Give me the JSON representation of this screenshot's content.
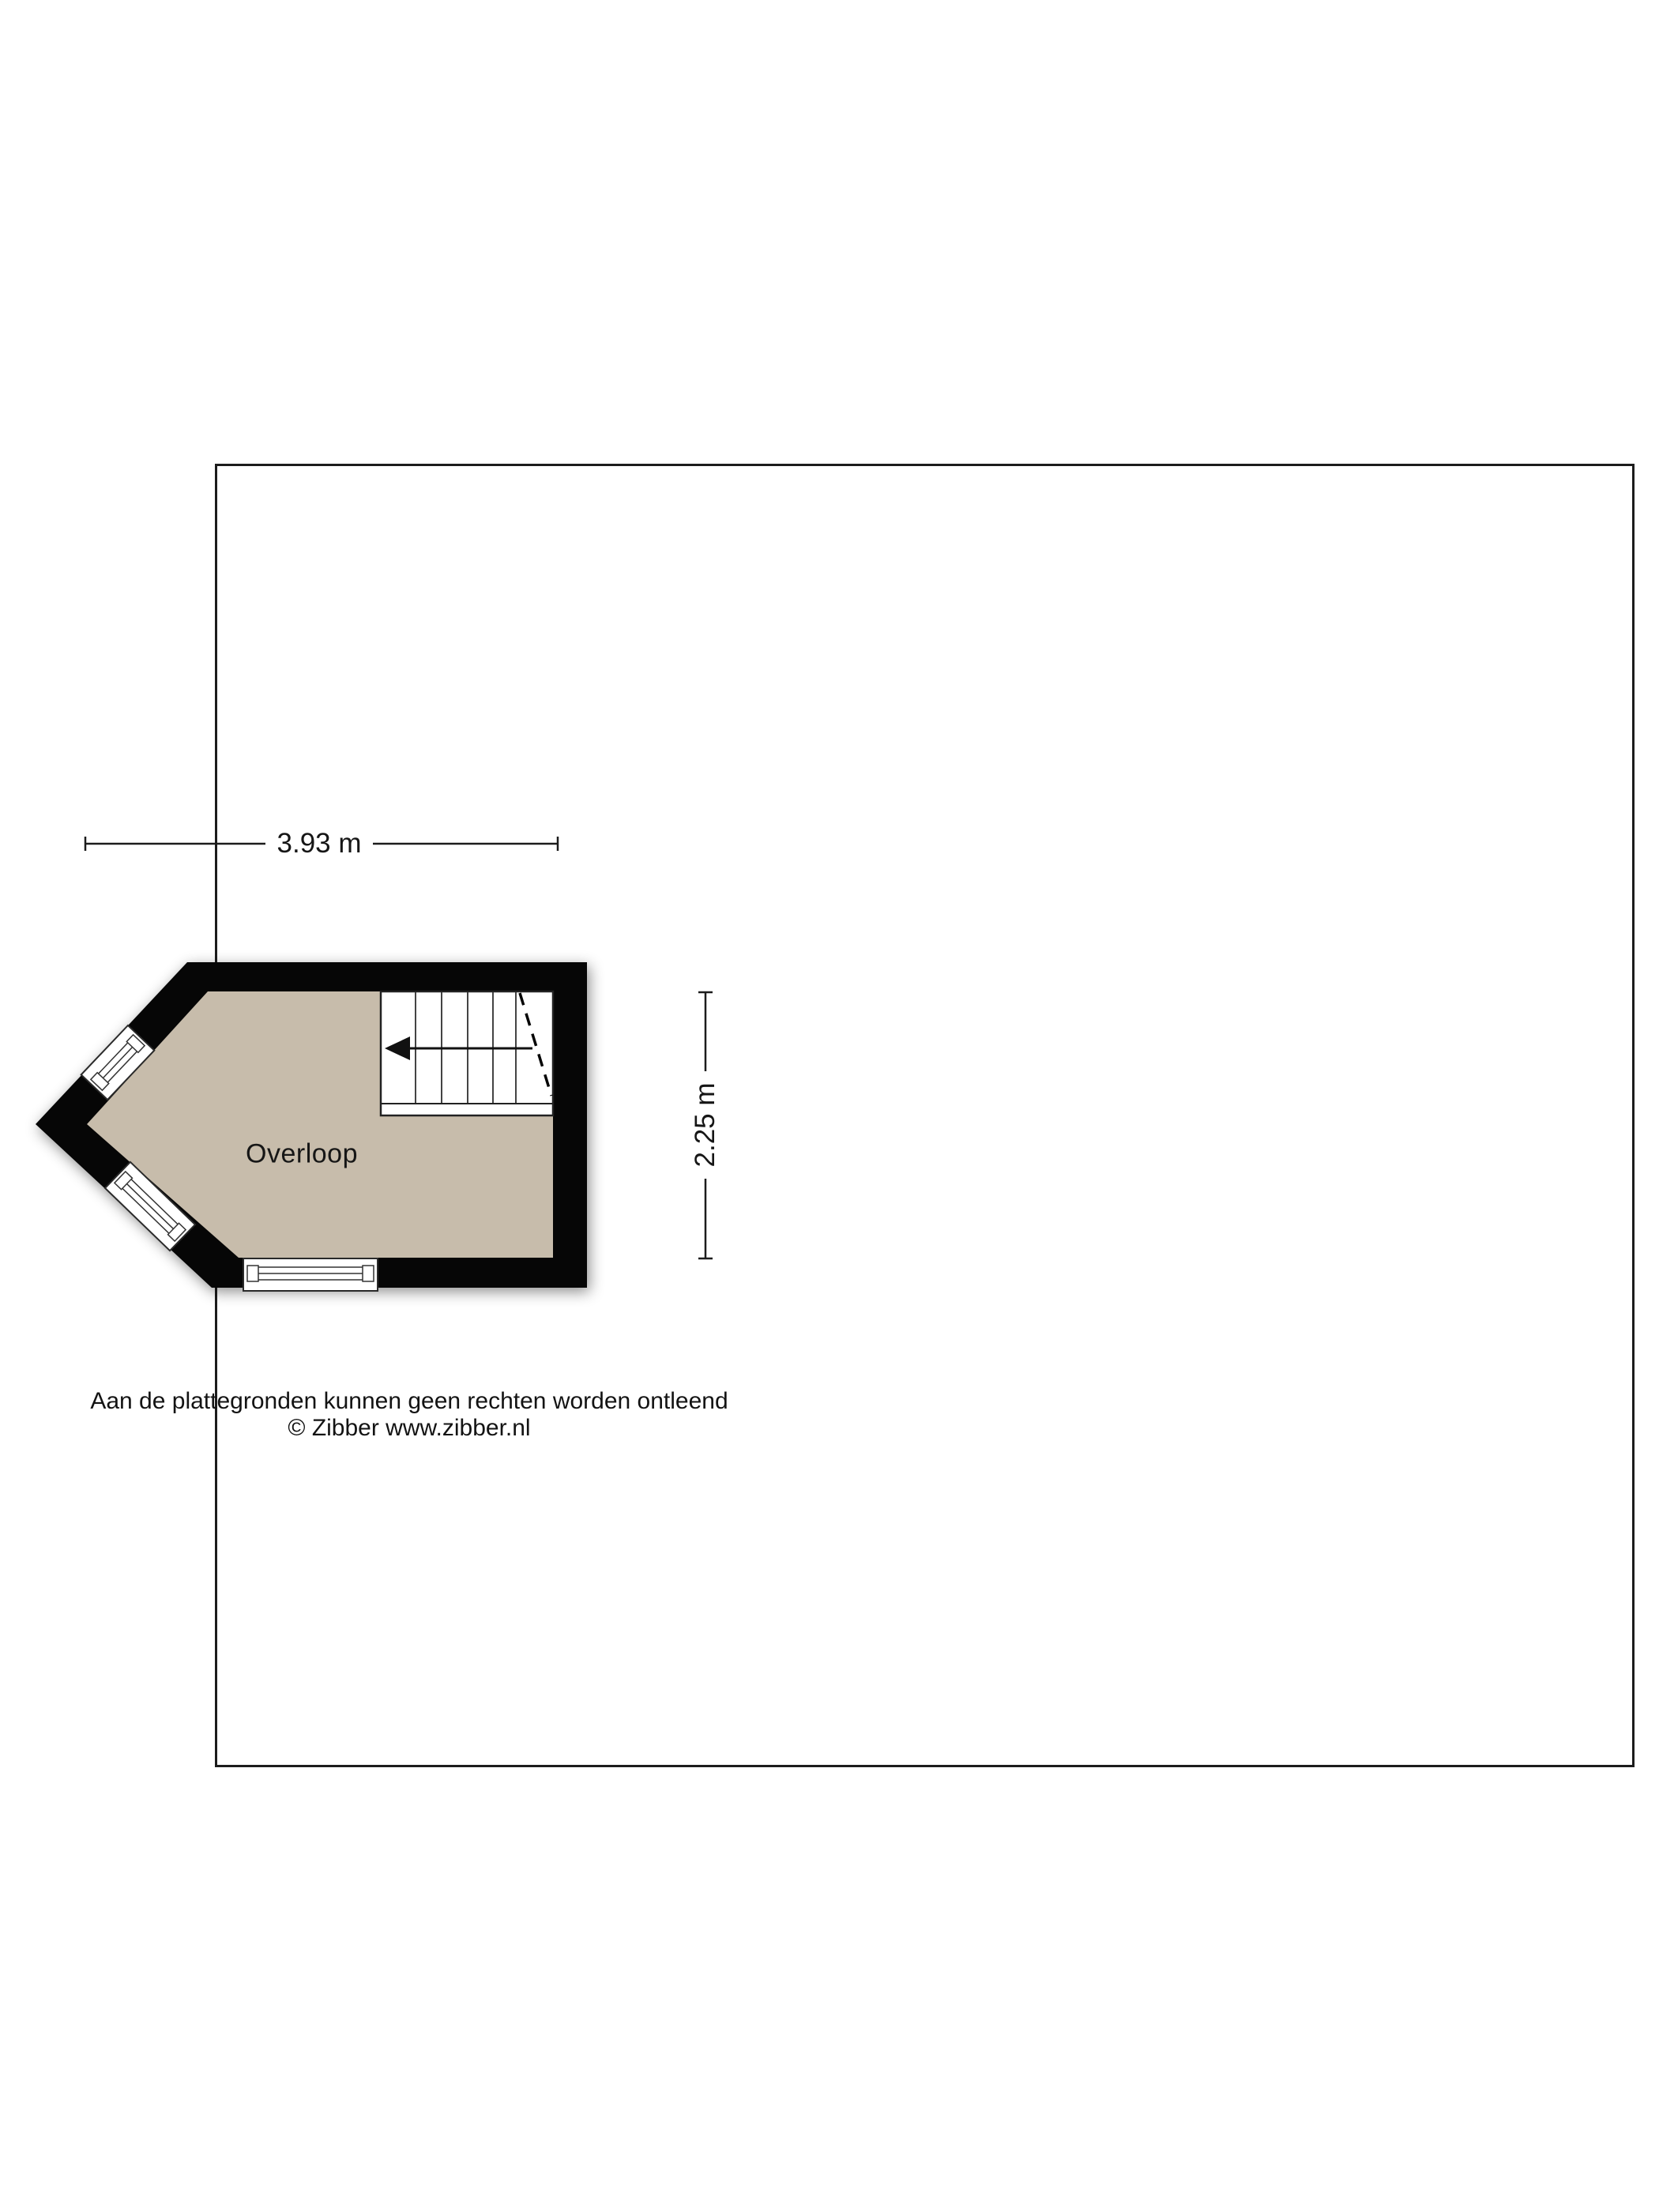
{
  "colors": {
    "wall": "#060606",
    "floor": "#c7bcab",
    "frame": "#1c1c1c",
    "detail": "#333333",
    "text": "#161616"
  },
  "floorplan": {
    "room_label": "Overloop",
    "stairs_arrow_direction": "left"
  },
  "dimensions": {
    "width_label": "3.93 m",
    "height_label": "2.25 m"
  },
  "footer": {
    "disclaimer": "Aan de plattegronden kunnen geen rechten worden ontleend",
    "copyright": "© Zibber www.zibber.nl"
  }
}
